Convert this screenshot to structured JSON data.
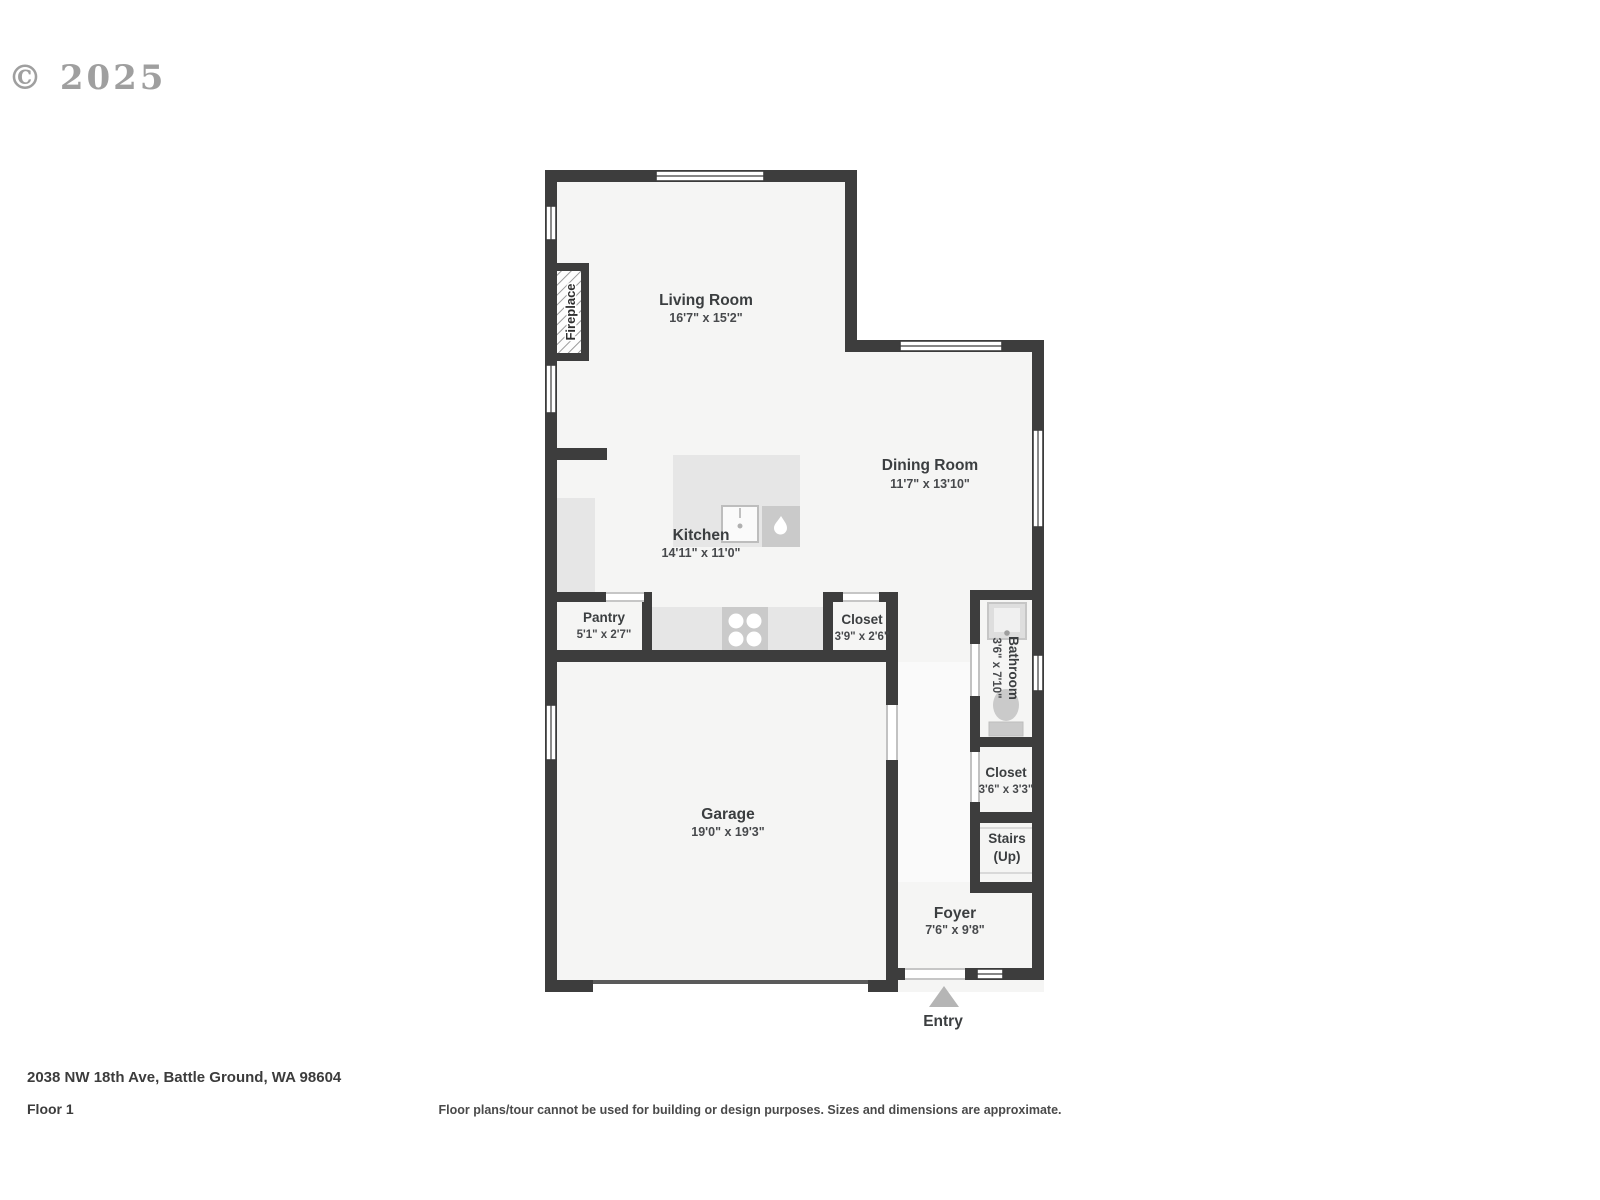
{
  "watermark": "© 2025",
  "footer": {
    "address": "2038 NW 18th Ave, Battle Ground, WA 98604",
    "floor": "Floor 1",
    "disclaimer": "Floor plans/tour cannot be used for building or design purposes. Sizes and dimensions are approximate."
  },
  "floorplan": {
    "colors": {
      "wall": "#3d3d3d",
      "floor": "#f5f5f4",
      "counter": "#e6e6e6",
      "appliance": "#cacaca",
      "label": "#3b3e40"
    },
    "rooms": [
      {
        "name": "Living Room",
        "dims": "16'7\" x 15'2\""
      },
      {
        "name": "Dining Room",
        "dims": "11'7\" x 13'10\""
      },
      {
        "name": "Kitchen",
        "dims": "14'11\" x 11'0\""
      },
      {
        "name": "Pantry",
        "dims": "5'1\" x 2'7\""
      },
      {
        "name": "Closet",
        "dims": "3'9\" x 2'6\""
      },
      {
        "name": "Bathroom",
        "dims": "3'6\" x 7'10\""
      },
      {
        "name": "Closet",
        "dims": "3'6\" x 3'3\""
      },
      {
        "name": "Stairs",
        "dims": "(Up)"
      },
      {
        "name": "Garage",
        "dims": "19'0\" x 19'3\""
      },
      {
        "name": "Foyer",
        "dims": "7'6\" x 9'8\""
      }
    ],
    "features": {
      "fireplace": "Fireplace",
      "entry": "Entry"
    }
  }
}
